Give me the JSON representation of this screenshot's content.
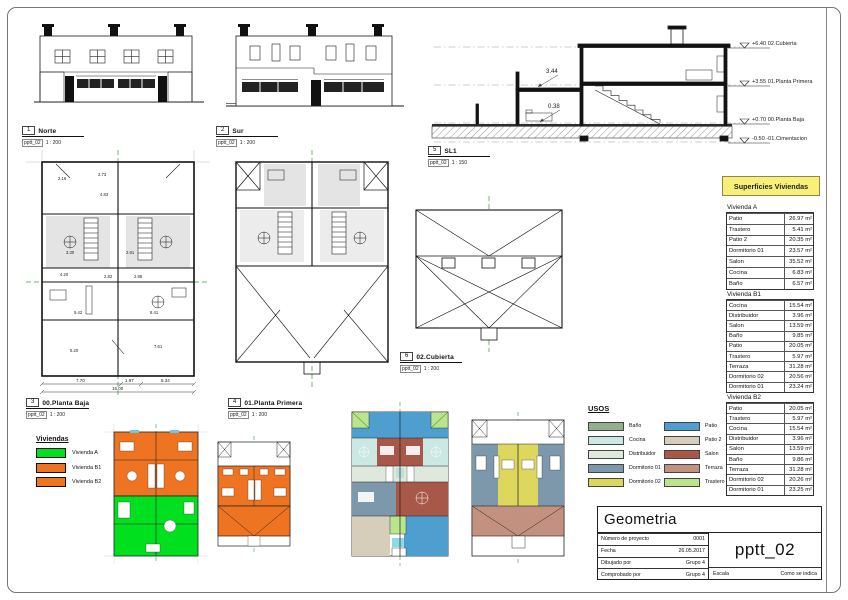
{
  "views": {
    "norte": {
      "num": "1",
      "name": "Norte",
      "ref": "pptt_02",
      "scale": "1 : 200"
    },
    "sur": {
      "num": "2",
      "name": "Sur",
      "ref": "pptt_02",
      "scale": "1 : 200"
    },
    "baja": {
      "num": "3",
      "name": "00.Planta Baja",
      "ref": "pptt_02",
      "scale": "1 : 200"
    },
    "primera": {
      "num": "4",
      "name": "01.Planta Primera",
      "ref": "pptt_02",
      "scale": "1 : 200"
    },
    "sl1": {
      "num": "5",
      "name": "SL1",
      "ref": "pptt_02",
      "scale": "1 : 150"
    },
    "cubierta": {
      "num": "6",
      "name": "02.Cubierta",
      "ref": "pptt_02",
      "scale": "1 : 200"
    }
  },
  "section": {
    "levels": [
      "+6.40 02.Cubierta",
      "+3.55 01.Planta Primera",
      "+0.70 00.Planta Baja",
      "-0.50 -01.Cimentacion"
    ],
    "dim_upper": "3.44",
    "dim_lower": "0.38"
  },
  "plan_dims": {
    "bottom_segments": [
      "7.70",
      "1.97",
      "5.34"
    ],
    "bottom_total": "15.00",
    "interior": [
      "2.16",
      "2.73",
      "4.83",
      "3.30",
      "2.91",
      "4.20",
      "2.82",
      "2.88",
      "5.42",
      "8.41",
      "5.20",
      "7.61"
    ]
  },
  "superficies": {
    "title": "Superficies Viviendas",
    "header_bg": "#f8ef7a",
    "tables": [
      {
        "heading": "Vivienda A",
        "rows": [
          {
            "label": "Patio",
            "value": "26.97 m²"
          },
          {
            "label": "Trastero",
            "value": "5.41 m²"
          },
          {
            "label": "Patio 2",
            "value": "20.35 m²"
          },
          {
            "label": "Dormitorio 01",
            "value": "23.57 m²"
          },
          {
            "label": "Salon",
            "value": "35.52 m²"
          },
          {
            "label": "Cocina",
            "value": "6.83 m²"
          },
          {
            "label": "Baño",
            "value": "6.57 m²"
          }
        ]
      },
      {
        "heading": "Vivienda B1",
        "rows": [
          {
            "label": "Cocina",
            "value": "15.54 m²"
          },
          {
            "label": "Distribuidor",
            "value": "3.96 m²"
          },
          {
            "label": "Salon",
            "value": "13.59 m²"
          },
          {
            "label": "Baño",
            "value": "9.85 m²"
          },
          {
            "label": "Patio",
            "value": "20.05 m²"
          },
          {
            "label": "Trastero",
            "value": "5.97 m²"
          },
          {
            "label": "Terraza",
            "value": "31.28 m²"
          },
          {
            "label": "Dormitorio 02",
            "value": "20.56 m²"
          },
          {
            "label": "Dormitorio 01",
            "value": "23.24 m²"
          }
        ]
      },
      {
        "heading": "Vivienda B2",
        "rows": [
          {
            "label": "Patio",
            "value": "20.05 m²"
          },
          {
            "label": "Trastero",
            "value": "5.97 m²"
          },
          {
            "label": "Cocina",
            "value": "15.54 m²"
          },
          {
            "label": "Distribuidor",
            "value": "3.96 m²"
          },
          {
            "label": "Salon",
            "value": "13.59 m²"
          },
          {
            "label": "Baño",
            "value": "9.86 m²"
          },
          {
            "label": "Terraza",
            "value": "31.28 m²"
          },
          {
            "label": "Dormitorio 02",
            "value": "20.26 m²"
          },
          {
            "label": "Dormitorio 01",
            "value": "23.25 m²"
          }
        ]
      }
    ]
  },
  "viviendas_legend": {
    "title": "Viviendas",
    "items": [
      {
        "label": "Vivienda A",
        "color": "#00e01e"
      },
      {
        "label": "Vivienda B1",
        "color": "#ef7422"
      },
      {
        "label": "Vivienda B2",
        "color": "#ef7422"
      }
    ]
  },
  "usos_legend": {
    "title": "USOS",
    "items": [
      {
        "label": "Baño",
        "color": "#93ae8c"
      },
      {
        "label": "Cocina",
        "color": "#cbe9e2"
      },
      {
        "label": "Distribuidor",
        "color": "#dfe8dc"
      },
      {
        "label": "Dormitorio 01",
        "color": "#7d97ab"
      },
      {
        "label": "Dormitorio 02",
        "color": "#ddd75e"
      },
      {
        "label": "Patio",
        "color": "#4e9fd0"
      },
      {
        "label": "Patio 2",
        "color": "#d6cebb"
      },
      {
        "label": "Salon",
        "color": "#a85848"
      },
      {
        "label": "Terraza",
        "color": "#c29180"
      },
      {
        "label": "Trastero",
        "color": "#b9e58c"
      }
    ]
  },
  "titleblock": {
    "title": "Geometria",
    "sheet_code": "pptt_02",
    "fields": [
      {
        "label": "Número de proyecto",
        "value": "0001"
      },
      {
        "label": "Fecha",
        "value": "26.05.2017"
      },
      {
        "label": "Dibujado por",
        "value": "Grupo 4"
      },
      {
        "label": "Comprobado por",
        "value": "Grupo 4"
      }
    ],
    "escala_label": "Escala",
    "escala_value": "Como se indica"
  }
}
